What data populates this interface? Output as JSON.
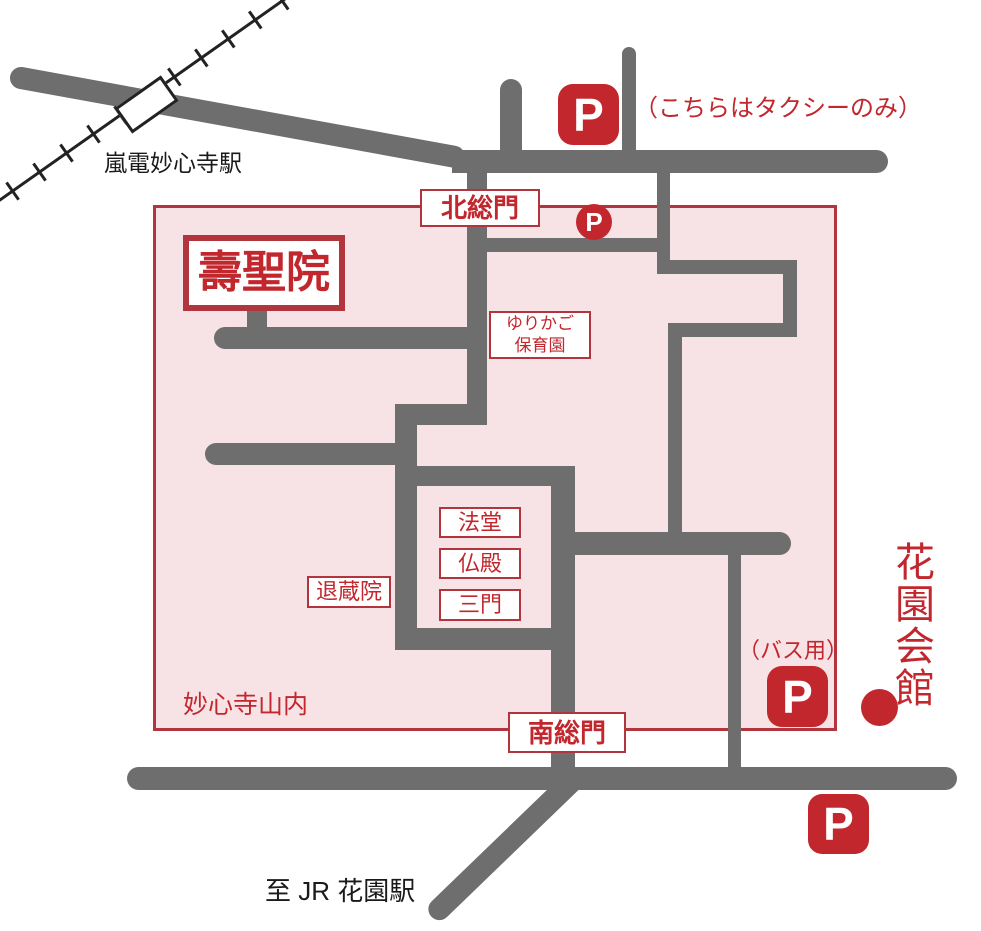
{
  "labels": {
    "randen_station": "嵐電妙心寺駅",
    "taxi_note": "（こちらはタクシーのみ）",
    "north_gate": "北総門",
    "jushoin": "壽聖院",
    "nursery_line1": "ゆりかご",
    "nursery_line2": "保育園",
    "hatto": "法堂",
    "butsuden": "仏殿",
    "sanmon": "三門",
    "taizoin": "退蔵院",
    "area": "妙心寺山内",
    "south_gate": "南総門",
    "bus_note": "（バス用）",
    "hanazono_kaikan": "花園会館",
    "jr_note": "至 JR 花園駅",
    "parking": "P"
  },
  "colors": {
    "road_gray": "#6e6e6e",
    "accent_red": "#c1272d",
    "box_border_red": "#b2353e",
    "area_fill_pink": "#f7e2e5",
    "railway_black": "#222222",
    "text_black": "#1a1a1a"
  }
}
